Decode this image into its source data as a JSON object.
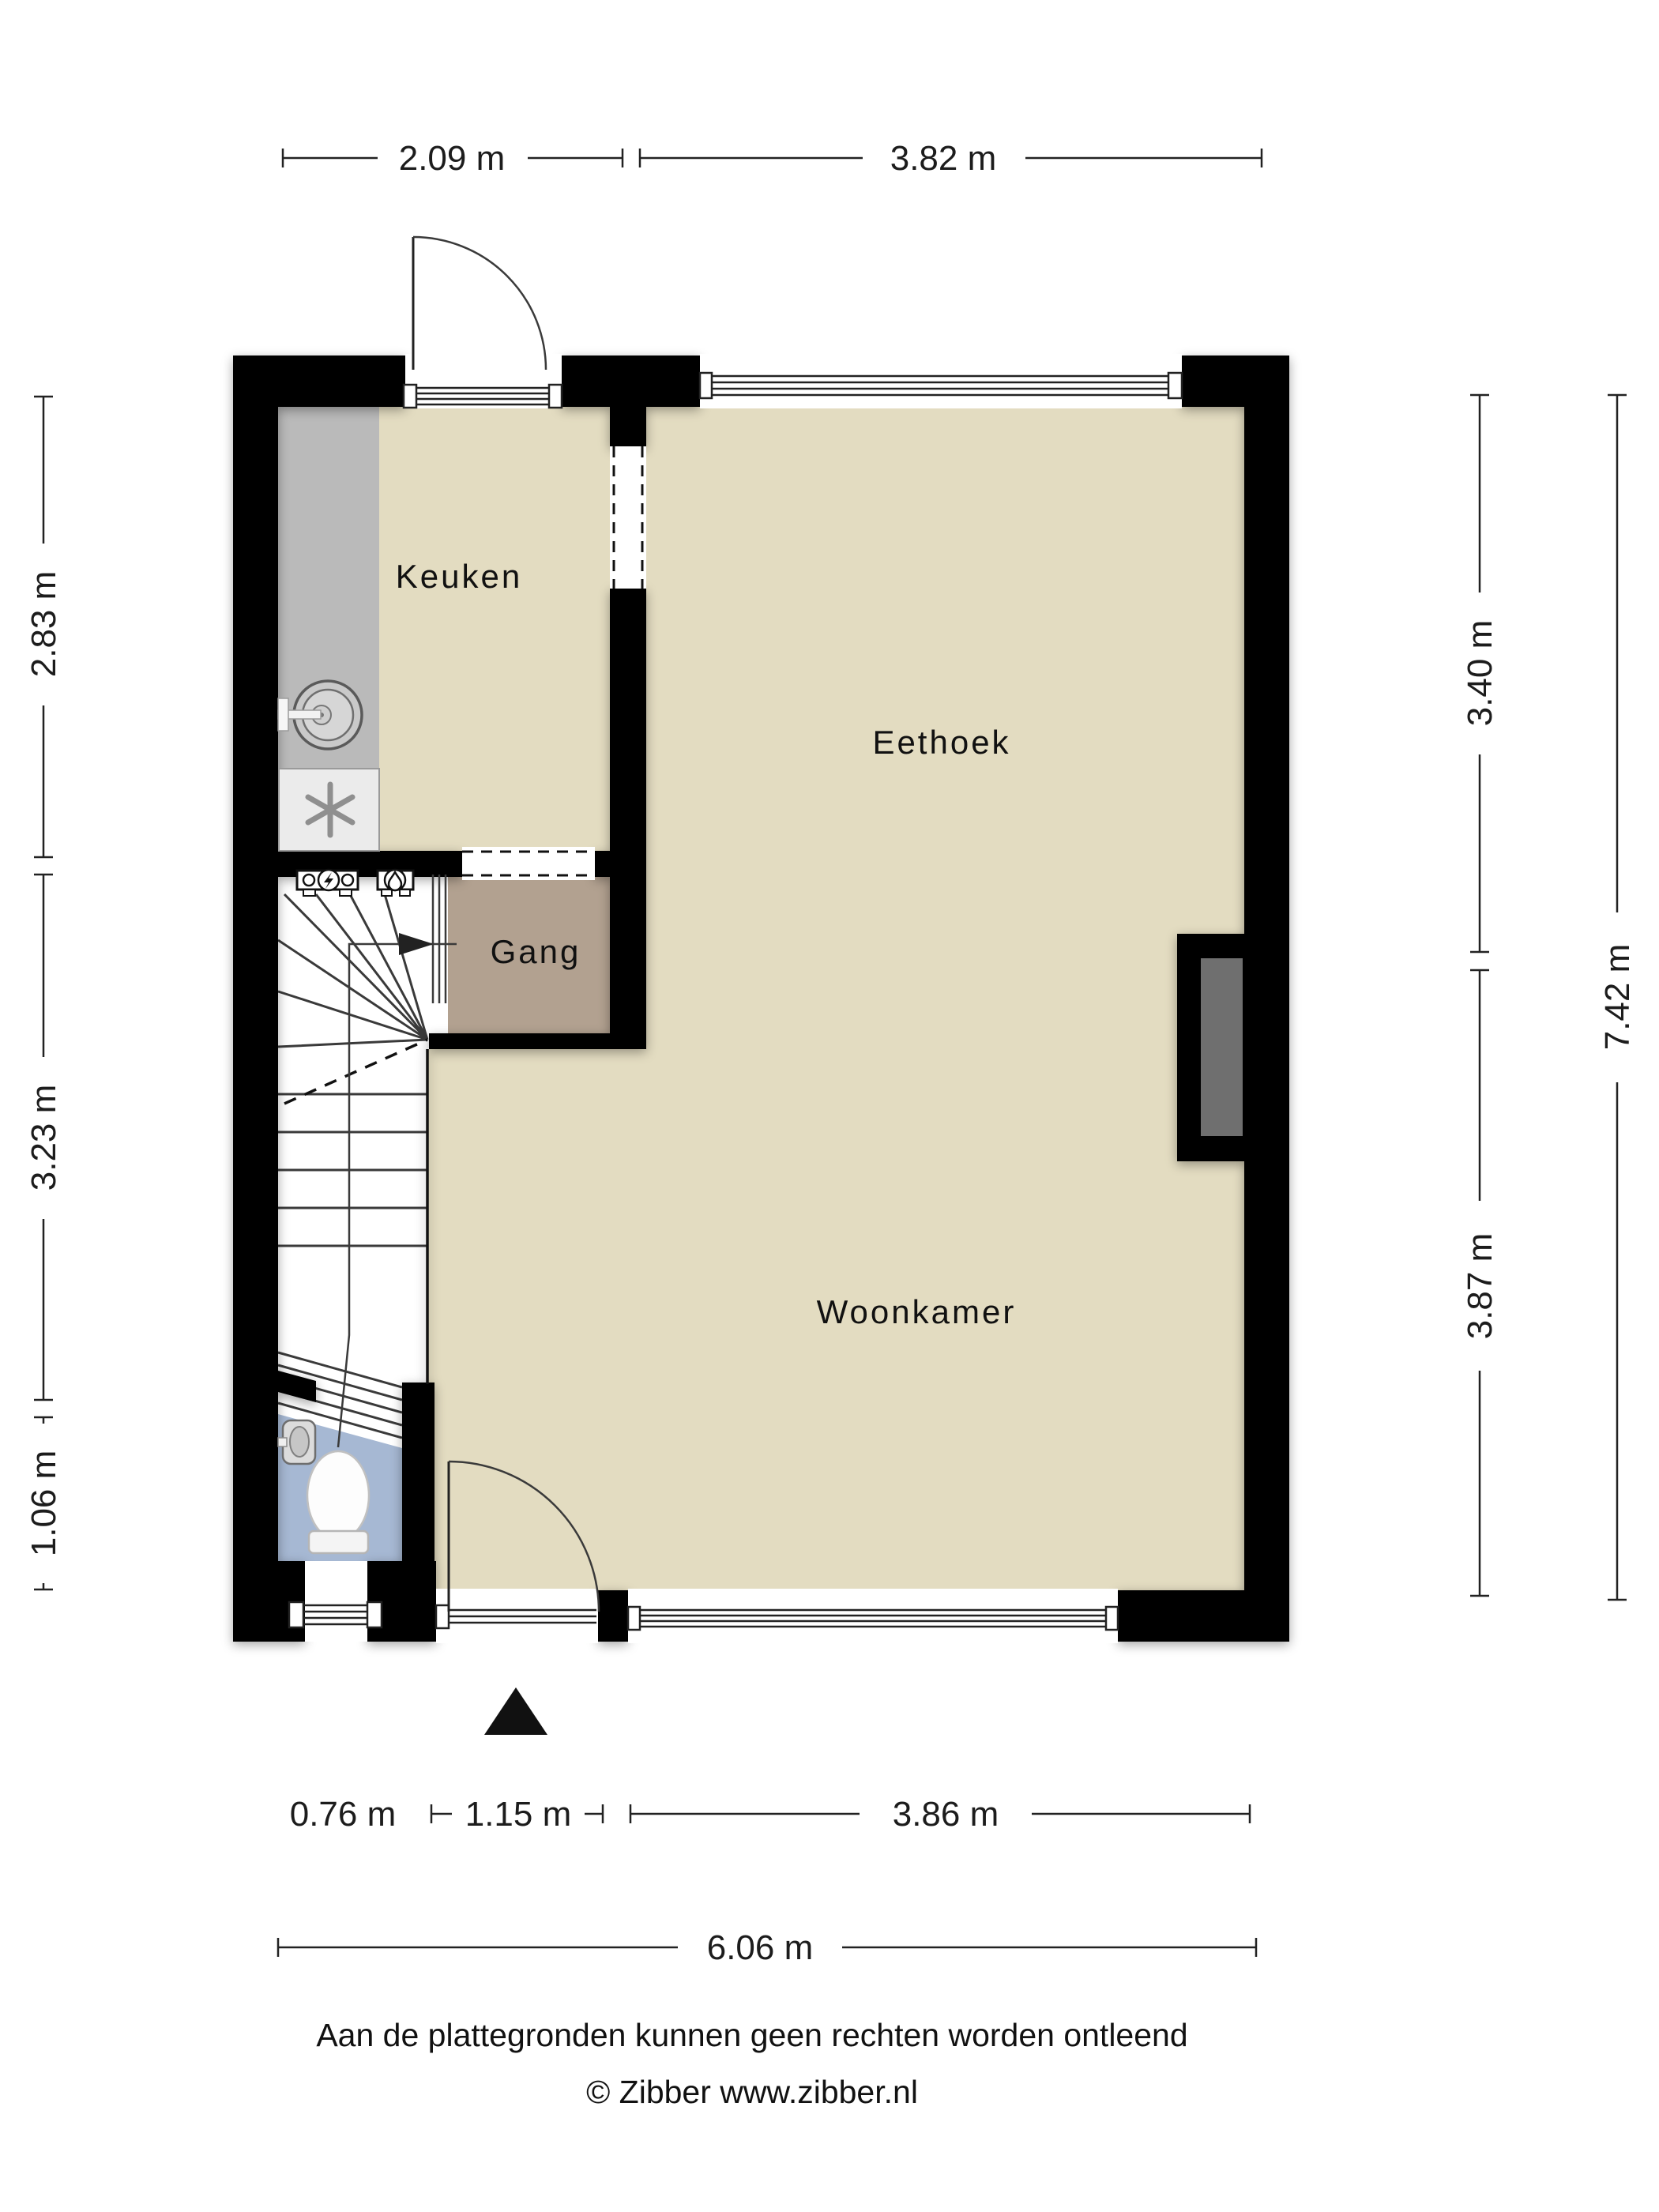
{
  "rooms": {
    "kitchen": "Keuken",
    "dining": "Eethoek",
    "hall": "Gang",
    "living": "Woonkamer"
  },
  "dimensions": {
    "top": [
      "2.09 m",
      "3.82 m"
    ],
    "left": [
      "2.83 m",
      "3.23 m",
      "1.06 m"
    ],
    "right_inner": [
      "3.40 m",
      "3.87 m"
    ],
    "right_outer": "7.42 m",
    "bottom": [
      "0.76 m",
      "1.15 m",
      "3.86 m"
    ],
    "bottom_total": "6.06 m"
  },
  "footer": {
    "disclaimer": "Aan de plattegronden kunnen geen rechten worden ontleend",
    "copyright": "© Zibber www.zibber.nl"
  },
  "colors": {
    "wall": "#000000",
    "floor-main": "#e3dcc1",
    "floor-hall": "#b2a190",
    "floor-wc": "#a6b8d3",
    "counter": "#bababa",
    "chimney": "#6f6f6f"
  }
}
